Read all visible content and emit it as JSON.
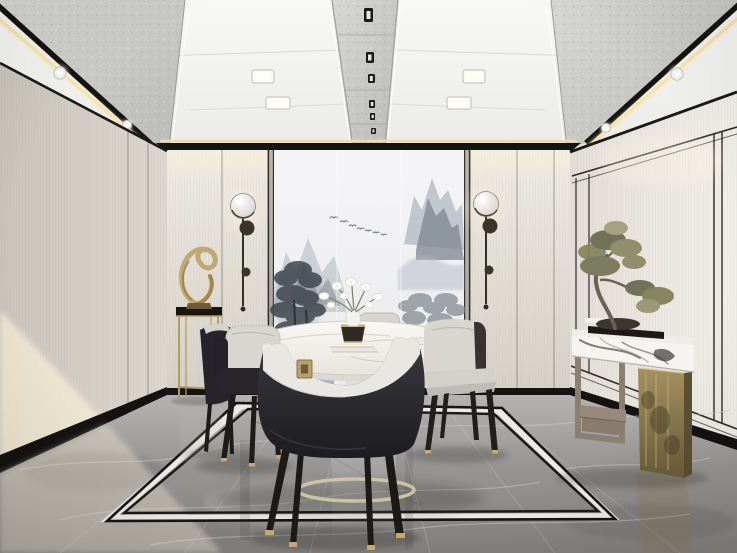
{
  "scene": {
    "title": "New Chinese style dining room interior render",
    "objects": {
      "ceiling": "Recessed white panel ceiling with concrete inlay strips, warm LED cove lines, square spotlights and round downlights",
      "back_wall": "Light fabric panel wall with black trim reveals",
      "mural": "Ink-wash mountain landscape mural in three panels with flying birds",
      "sconce_left": "Bronze stem wall sconce with glowing glass globe",
      "sconce_right": "Bronze stem wall sconce with glowing glass globe",
      "sculpture": "Gold twisted ribbon sculpture on slim gold pedestal stand",
      "dining_table": "Oval white marble dining table on polished metal slat legs with curved base ring",
      "near_chair": "Black leather chair with curved light top rail and gold square buckle",
      "left_chairs": "Two black leather chairs with light grey fabric backs",
      "right_chair": "Light grey fabric chair with black leather shell",
      "far_chair": "Light grey fabric chair behind table",
      "table_items": "White lily flowers in vase on dark gold-rimmed pot over stacked white books",
      "console": "Veined marble console slab on grey wood frame leg and aged brass panel leg with stepped wood stool",
      "bonsai": "Olive-green penjing bonsai on black tray",
      "floor": "Grey marble floor with white-and-black rectangular inlay border",
      "sunlight": "Warm sunlight patch across left wall and floor"
    }
  },
  "palette": {
    "ceiling_white": "#f4f4f2",
    "concrete": "#c9cac6",
    "trim_black": "#171614",
    "led_gold": "#f0d79c",
    "glow_warm": "#fff3d6",
    "wall_back": "#e6e2da",
    "wall_left": "#d3cfc7",
    "wall_right": "#edeae3",
    "baseboard": "#141311",
    "mural_bg": "#f3f3f5",
    "ink_dark": "#3f474f",
    "ink_mid": "#7d858f",
    "ink_light": "#b4bbc4",
    "floor_light": "#b2b0ae",
    "floor_mid": "#949290",
    "floor_dark": "#7b7977",
    "border_white": "#eceae6",
    "marble_white": "#f6f4f0",
    "marble_shadow": "#ddd8d0",
    "leather_black": "#27262a",
    "fabric_light": "#d9d6d0",
    "metal_gold": "#c0a873",
    "brass_dark": "#77663f",
    "wood": "#8b7f72",
    "foliage": "#85855f",
    "fixture_bronze": "#3a342c"
  }
}
